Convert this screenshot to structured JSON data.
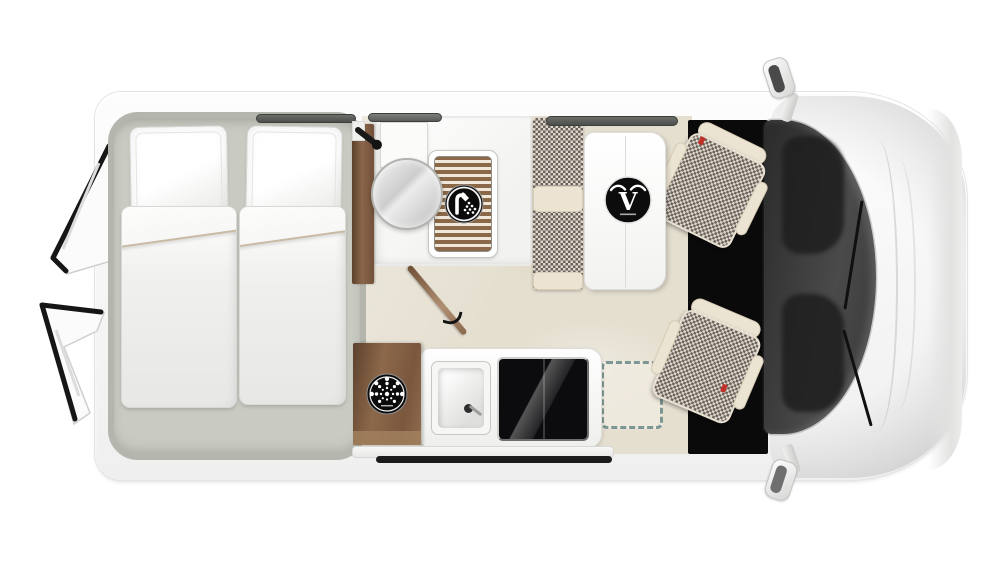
{
  "document": {
    "kind": "campervan top-view floor plan illustration"
  },
  "logo": {
    "letter": "V"
  },
  "icons": [
    {
      "name": "shower-icon",
      "meaning": "shower head with water spray, white on black disc"
    },
    {
      "name": "fridge-vent-icon",
      "meaning": "radial dotted starburst badge, white on black disc"
    },
    {
      "name": "brand-logo",
      "meaning": "letter V with horn flourishes, white on black disc"
    }
  ],
  "zones": [
    {
      "id": "rear-bedroom",
      "features": [
        "twin-bed-left",
        "twin-bed-right",
        "rear-window"
      ]
    },
    {
      "id": "wardrobe-partition",
      "features": [
        "wall-faucet"
      ]
    },
    {
      "id": "bathroom",
      "features": [
        "vanity-cabinet",
        "washbasin",
        "shower-tray",
        "open-door"
      ]
    },
    {
      "id": "kitchen",
      "features": [
        "sink",
        "two-burner-hob"
      ]
    },
    {
      "id": "appliance-cabinet",
      "features": [
        "fridge-vent-icon"
      ]
    },
    {
      "id": "dinette",
      "features": [
        "bench-seat",
        "split-table",
        "brand-logo"
      ]
    },
    {
      "id": "optional-area",
      "features": [
        "dashed-outline"
      ]
    },
    {
      "id": "cab",
      "features": [
        "passenger-swivel-seat",
        "driver-swivel-seat",
        "windshield",
        "wipers"
      ]
    },
    {
      "id": "exterior",
      "features": [
        "open-rear-doors",
        "entry-step",
        "wing-mirror-top",
        "wing-mirror-bottom"
      ]
    }
  ],
  "colors": {
    "body_white": "#f6f6f6",
    "bed_platform": "#c9cac2",
    "floor_beige": "#e5dfd0",
    "wood_brown": "#8a664a",
    "upholstery_check_dark": "#6b6258",
    "upholstery_check_light": "#ddd7cf",
    "cream_trim": "#ece4d2",
    "glass_dark": "#3a3a3a",
    "cab_floor_black": "#0a0a0a",
    "dashed_outline_teal": "#7c9694",
    "badge_black": "#0c0c0c"
  }
}
